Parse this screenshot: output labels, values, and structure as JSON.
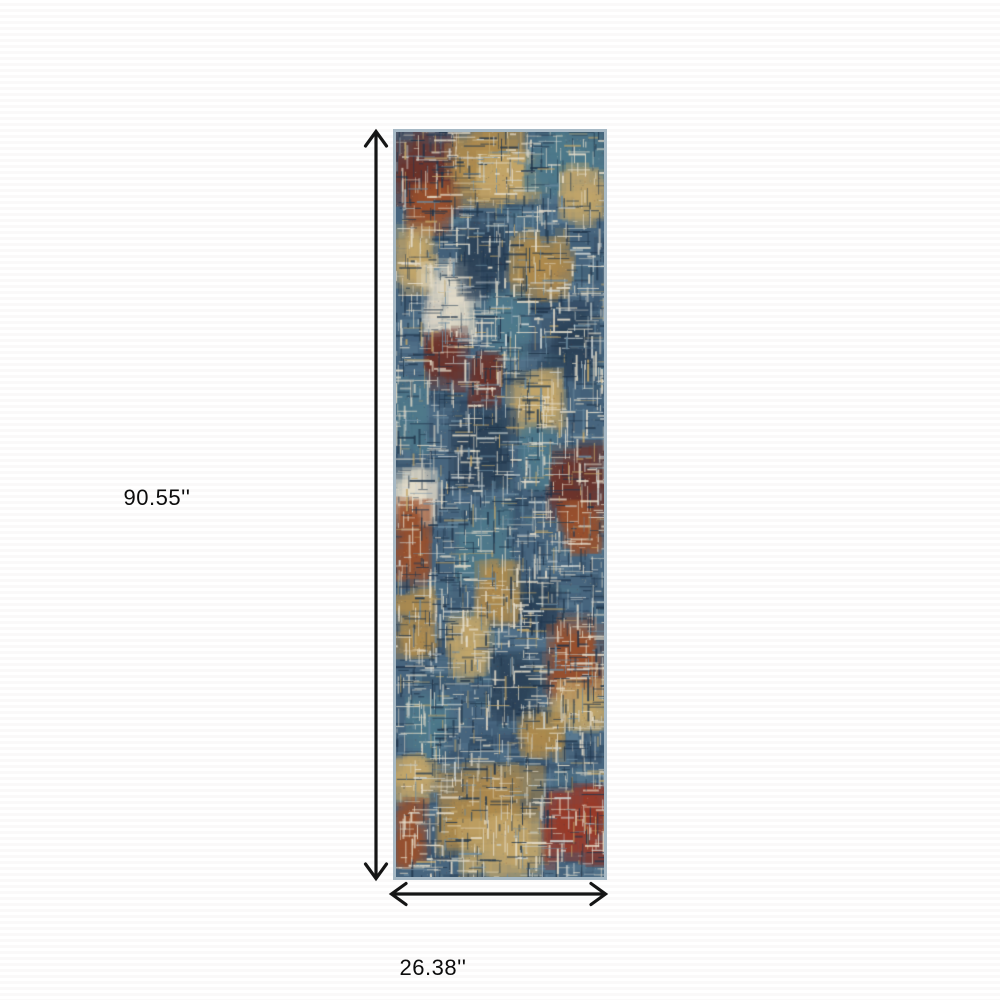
{
  "diagram": {
    "title": "rug-dimension-diagram",
    "background_color": "#ffffff",
    "stripe_color": "#faf9f9"
  },
  "dimensions": {
    "height_label": "90.55''",
    "width_label": "26.38''"
  },
  "arrows": {
    "color": "#151515",
    "height_arrow": "vertical-double-headed",
    "width_arrow": "horizontal-double-headed"
  },
  "rug": {
    "description": "multicolor abstract distressed crosshatch runner rug",
    "border_color": "#a7b9c5",
    "palette": {
      "base_blue": "#47657e",
      "dark_navy": "#2d4359",
      "deep_navy": "#22384e",
      "teal": "#4f7a8c",
      "light_blue": "#6b8ba0",
      "maroon": "#6e332a",
      "rust": "#9a512e",
      "rust_red": "#9c3a28",
      "gold": "#b08c4e",
      "tan": "#c4a76b",
      "cream": "#e6decb",
      "light_gray": "#cdd4d3"
    }
  }
}
